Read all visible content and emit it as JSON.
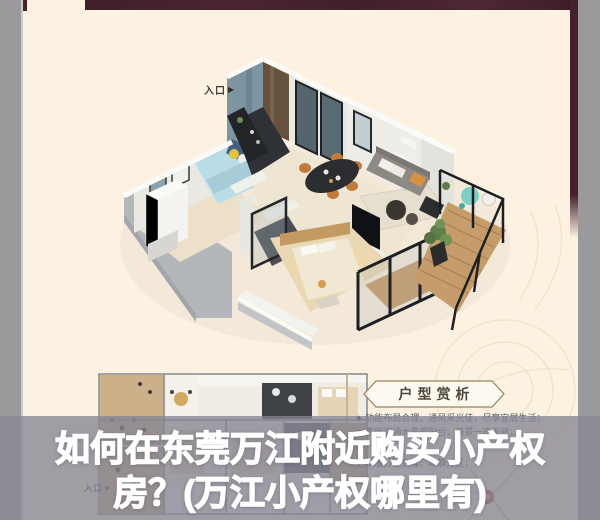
{
  "poster": {
    "plan3d": {
      "entrance_label": "入口",
      "entrance_arrow": "▶"
    },
    "plan2d": {
      "entrance_label": "入口",
      "entrance_arrow": "▶"
    },
    "analysis": {
      "banner_title": "户型赏析",
      "bullets": [
        {
          "marker": "◆",
          "text": "功能布局合理，通风采光佳，尽享宜居生活；"
        },
        {
          "marker": "◆",
          "text": "客厅连通大景观阳台，美景一览无遮；"
        },
        {
          "marker": "◆",
          "text": "干湿分区合理，动静分区；"
        }
      ]
    }
  },
  "caption": {
    "line1": "如何在东莞万江附近购买小产权",
    "line2": "房？(万江小产权哪里有)"
  },
  "colors": {
    "background_cream": "#fdf2e2",
    "border_maroon": "#46222d",
    "edge_gray": "#9a9a9c",
    "overlay_gray": "rgba(134,133,147,0.78)",
    "caption_white": "#ffffff",
    "banner_outline_brown": "#97825f",
    "balcony_wood": "#c69d6a",
    "accent_red_marker": "#b8443a"
  }
}
